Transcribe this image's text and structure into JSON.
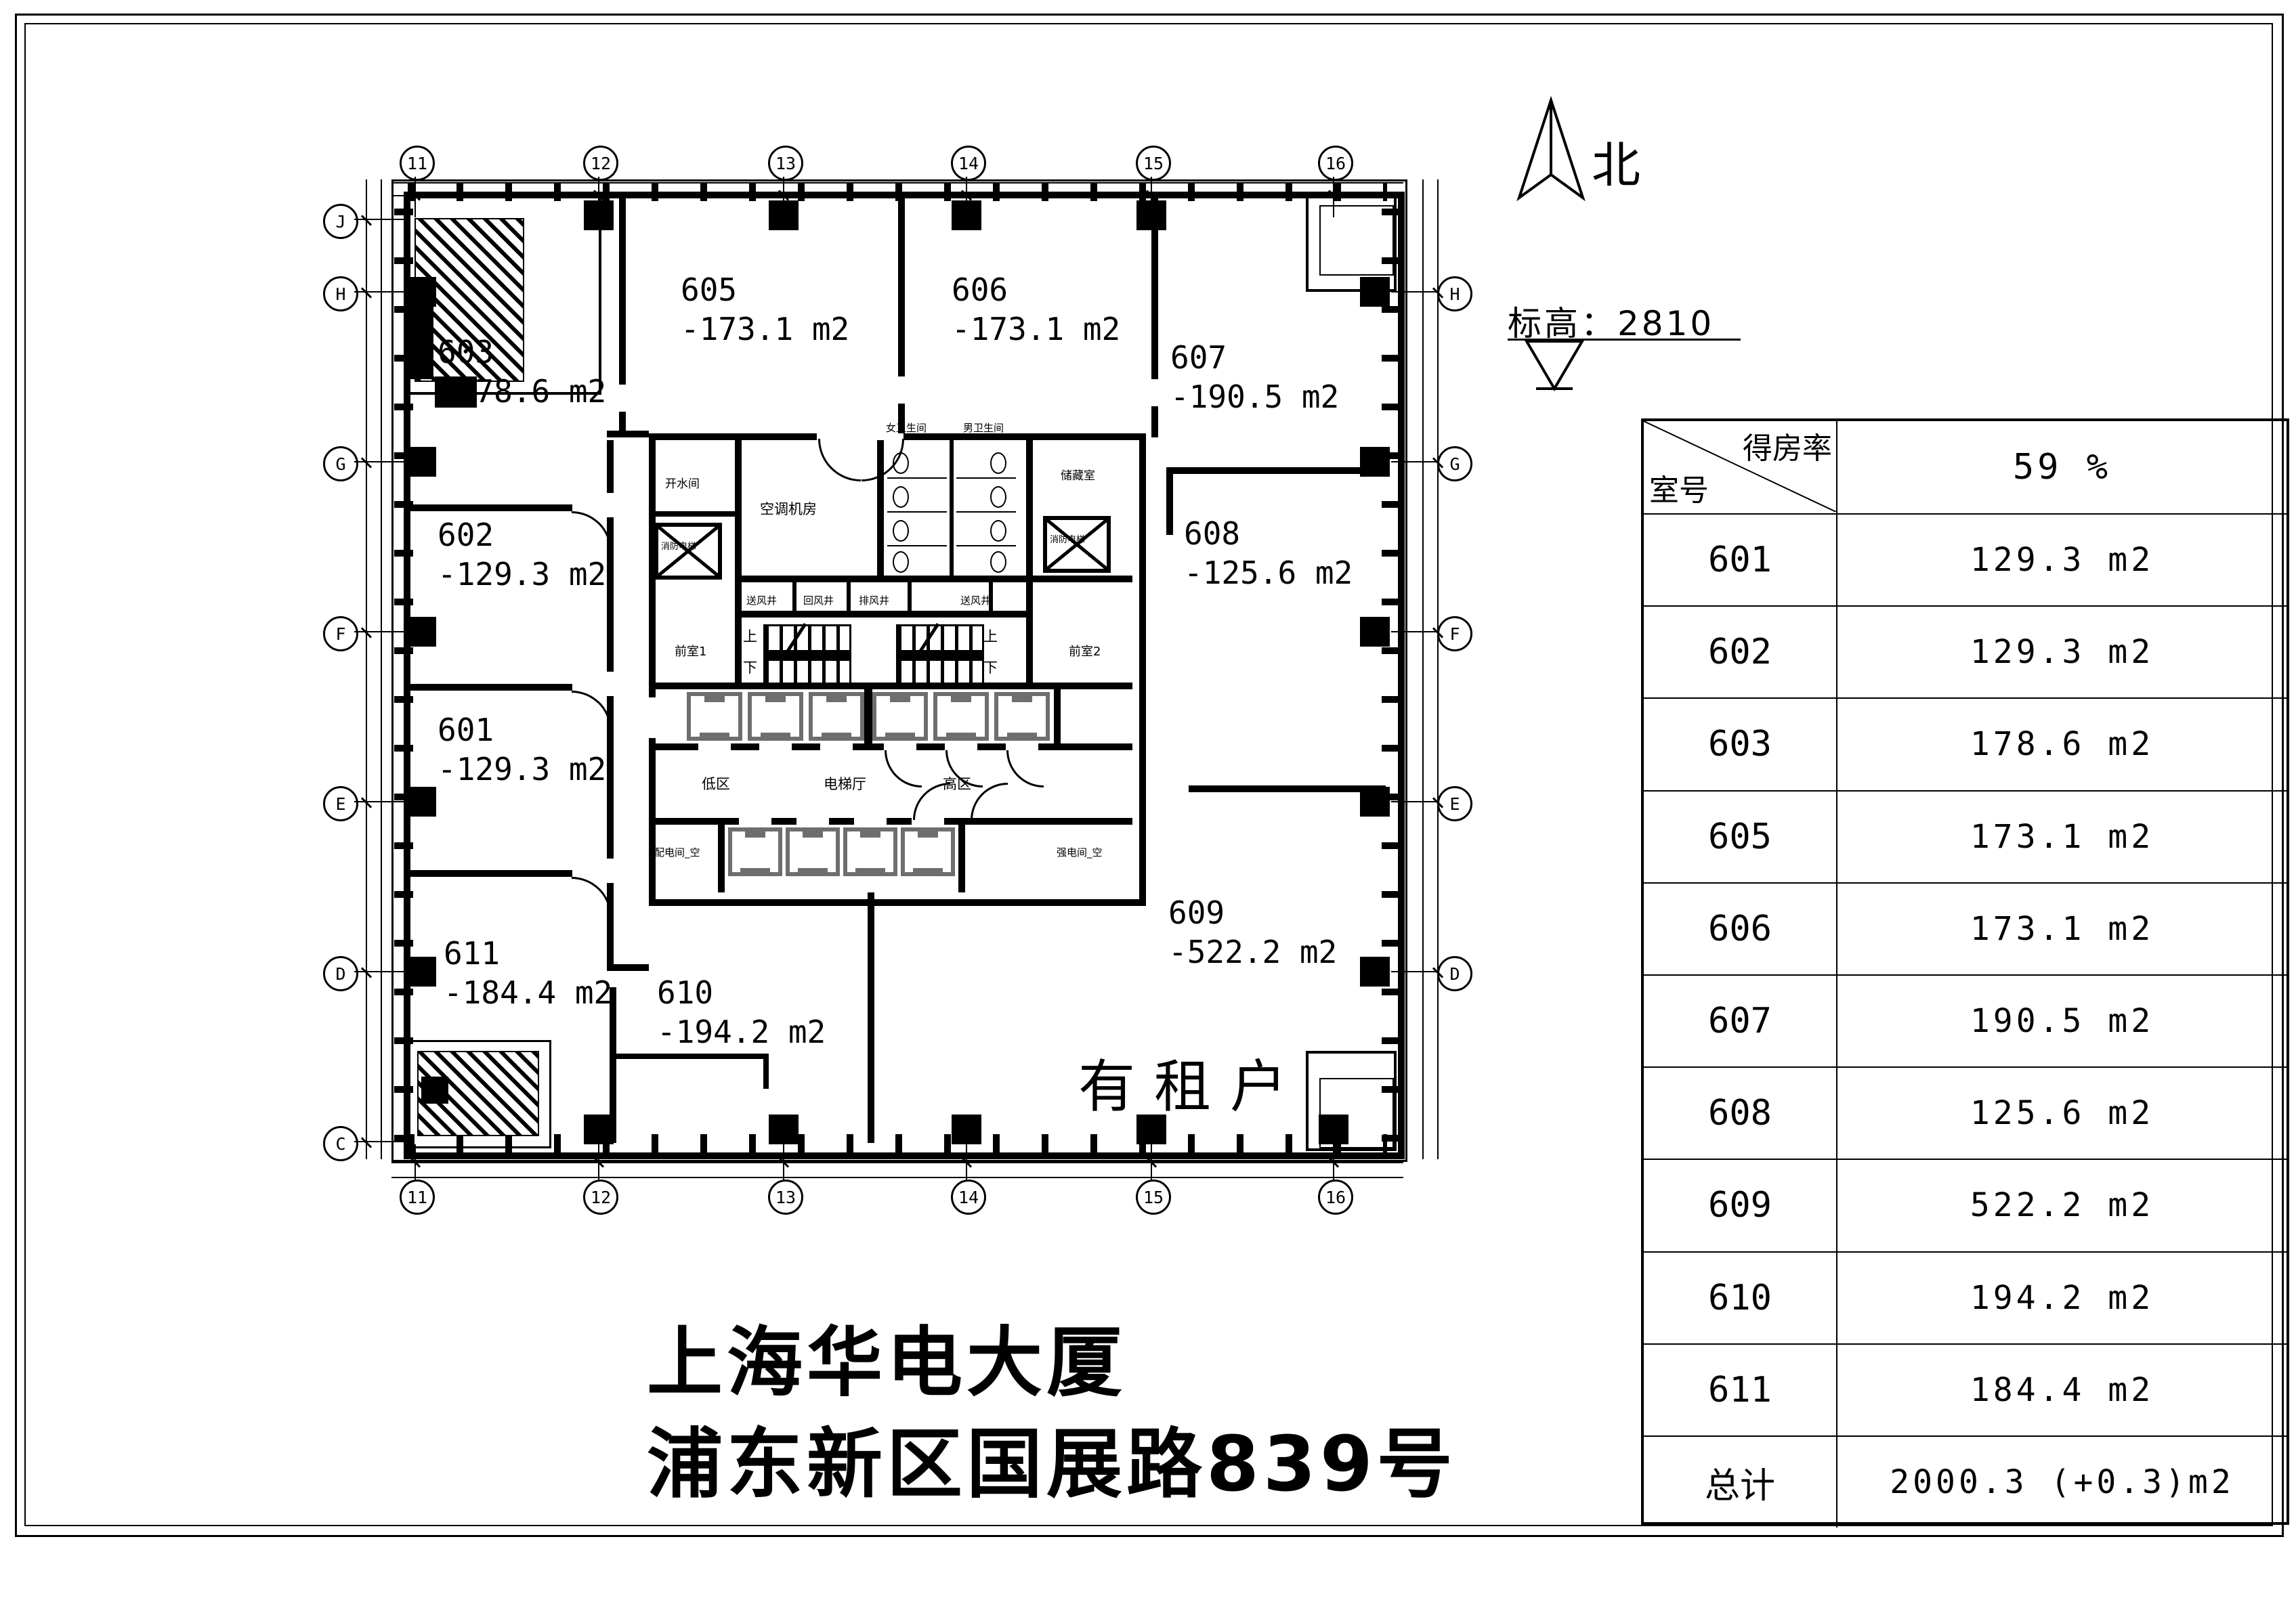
{
  "sheet": {
    "title_line1": "上海华电大厦",
    "title_line2": "浦东新区国展路839号"
  },
  "annotations": {
    "north_label": "北",
    "elevation_label": "标高：2810",
    "tenant_note": "有租户"
  },
  "grid": {
    "top": [
      "11",
      "12",
      "13",
      "14",
      "15",
      "16"
    ],
    "bottom": [
      "11",
      "12",
      "13",
      "14",
      "15",
      "16"
    ],
    "left": [
      "J",
      "H",
      "G",
      "F",
      "E",
      "D",
      "C"
    ],
    "right": [
      "H",
      "G",
      "F",
      "E",
      "D"
    ]
  },
  "rooms": [
    {
      "id": "603",
      "area": "-178.6 m2"
    },
    {
      "id": "605",
      "area": "-173.1 m2"
    },
    {
      "id": "606",
      "area": "-173.1 m2"
    },
    {
      "id": "607",
      "area": "-190.5 m2"
    },
    {
      "id": "602",
      "area": "-129.3 m2"
    },
    {
      "id": "601",
      "area": "-129.3 m2"
    },
    {
      "id": "608",
      "area": "-125.6 m2"
    },
    {
      "id": "611",
      "area": "-184.4 m2"
    },
    {
      "id": "610",
      "area": "-194.2 m2"
    },
    {
      "id": "609",
      "area": "-522.2 m2"
    }
  ],
  "core_labels": [
    "开水间",
    "空调机房",
    "储藏室",
    "女卫生间",
    "男卫生间",
    "送风井",
    "回风井",
    "排风井",
    "送风井",
    "前室1",
    "前室2",
    "上",
    "下",
    "上",
    "下",
    "低区",
    "电梯厅",
    "高区",
    "配电间_空",
    "强电间_空",
    "消防电梯",
    "消防电梯"
  ],
  "table": {
    "header_diag_top": "得房率",
    "header_diag_bottom": "室号",
    "header_value": "59 %",
    "rows": [
      [
        "601",
        "129.3 m2"
      ],
      [
        "602",
        "129.3 m2"
      ],
      [
        "603",
        "178.6 m2"
      ],
      [
        "605",
        "173.1 m2"
      ],
      [
        "606",
        "173.1 m2"
      ],
      [
        "607",
        "190.5 m2"
      ],
      [
        "608",
        "125.6 m2"
      ],
      [
        "609",
        "522.2 m2"
      ],
      [
        "610",
        "194.2 m2"
      ],
      [
        "611",
        "184.4 m2"
      ],
      [
        "总计",
        "2000.3 (+0.3)m2"
      ]
    ]
  }
}
